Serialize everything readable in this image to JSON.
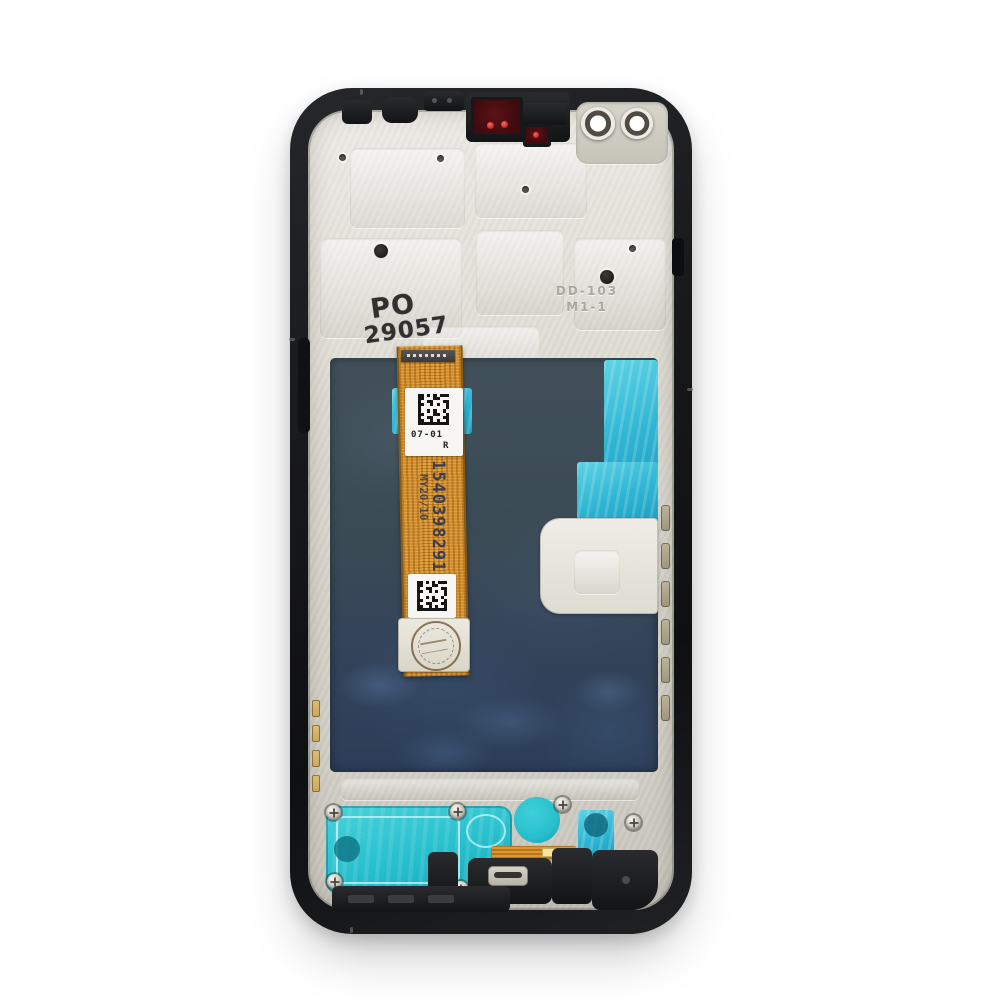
{
  "photo": {
    "description": "Product photo: back side of a smartphone LCD display assembly with black frame, metal shield, flex cable and adhesive pads",
    "background": "#ffffff",
    "markings": {
      "metal_stamp": {
        "line1": "PO",
        "line2": "29057"
      },
      "embossed": {
        "line1": "DD-103",
        "line2": "M1-1"
      },
      "flex_label_top": {
        "date_code": "07-01",
        "side": "R"
      },
      "flex_serial": {
        "number": "1540398291",
        "suffix": "06",
        "batch": "MY20/10"
      }
    },
    "colors": {
      "background": "#ffffff",
      "frame": "#1a1b1d",
      "metal": "#dcd9d0",
      "metal_bright": "#ecebe5",
      "panel_top": "#41505a",
      "panel_bottom": "#2c3e58",
      "adhesive_cyan": "#2fb6d4",
      "speaker_teal": "#27bfcd",
      "flex_orange": "#dd9733",
      "flex_orange_dark": "#b5761c",
      "label_white": "#f7f6f2",
      "sensor_window_red": "#3f0b0f",
      "sensor_dot_red": "#d4302f",
      "contact_gold": "#c9a75e",
      "ink_navy": "#303752"
    }
  }
}
